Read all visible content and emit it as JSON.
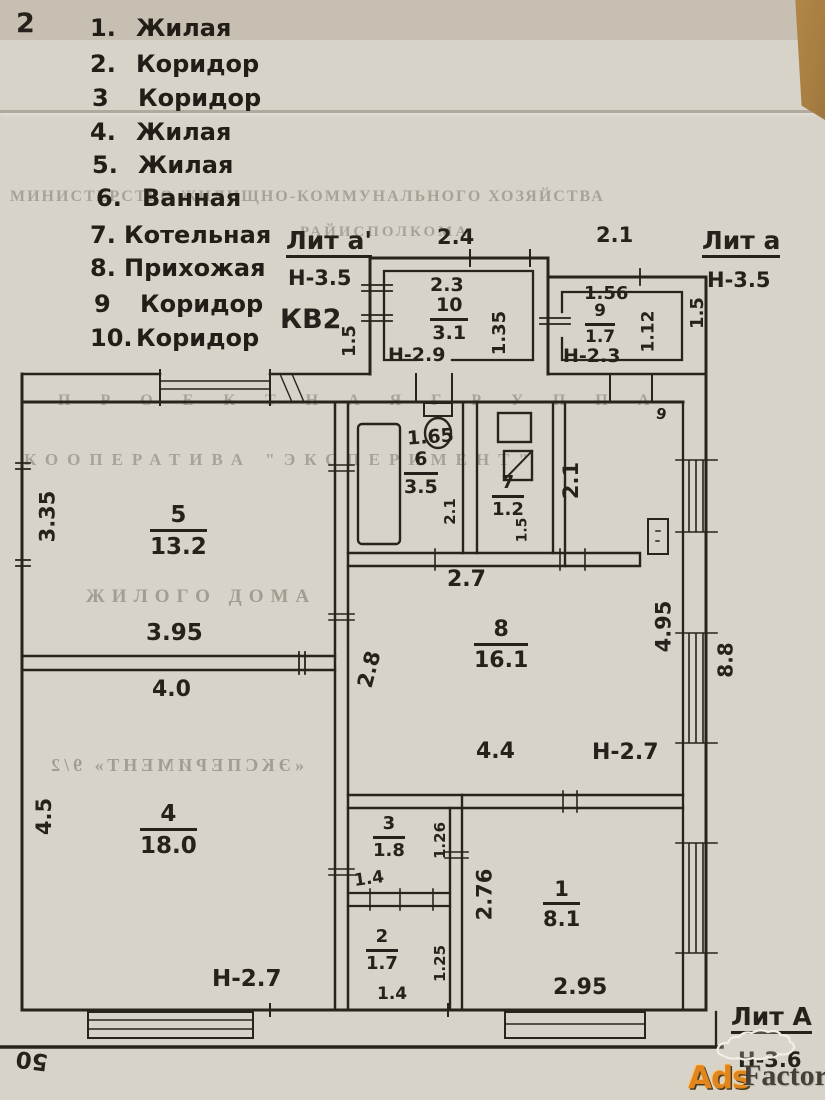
{
  "page": {
    "corner_mark": "2"
  },
  "legend": {
    "items": [
      {
        "num": "1.",
        "name": "Жилая"
      },
      {
        "num": "2.",
        "name": "Коридор"
      },
      {
        "num": "3",
        "name": "Коридор"
      },
      {
        "num": "4.",
        "name": "Жилая"
      },
      {
        "num": "5.",
        "name": "Жилая"
      },
      {
        "num": "6.",
        "name": "Ванная"
      },
      {
        "num": "7.",
        "name": "Котельная"
      },
      {
        "num": "8.",
        "name": "Прихожая"
      },
      {
        "num": "9",
        "name": "Коридор"
      },
      {
        "num": "10.",
        "name": "Коридор"
      }
    ]
  },
  "ghost": {
    "line1": "МИНИСТЕРСТВО ЖИЛИЩНО-КОММУНАЛЬНОГО ХОЗЯЙСТВА",
    "line2": "РАЙИСПОЛКОМА",
    "line3": "П Р О Е К Т Н А Я   Г Р У П П А",
    "line4": "КООПЕРАТИВА \"ЭКСПЕРИМЕНТ\"",
    "line5": "ЖИЛОГО ДОМА",
    "line6": "«ЭКСПЕРИМЕНТ» 9/2"
  },
  "plan": {
    "kv": "КВ2",
    "lit_a1": {
      "title": "Лит а'",
      "height": "Н-3.5"
    },
    "lit_a": {
      "title": "Лит а",
      "height": "Н-3.5"
    },
    "lit_A": {
      "title": "Лит А",
      "height": "Н-3.6"
    },
    "dims": {
      "kv_side": "1.5",
      "lit_a_side": "1.5",
      "top_left": "2.4",
      "top_right": "2.1",
      "mid_27": "2.7",
      "vert_21": "2.1",
      "right_88": "8.8",
      "bottom_50": "50",
      "door_mark": "9"
    },
    "rooms": {
      "r10": {
        "num": "10",
        "area": "3.1",
        "height": "Н-2.9",
        "d_top": "2.3",
        "d_side": "1.35"
      },
      "r9": {
        "num": "9",
        "area": "1.7",
        "height": "Н-2.3",
        "d_top": "1.56",
        "d_side": "1.12"
      },
      "r5": {
        "num": "5",
        "area": "13.2",
        "d_left": "3.35",
        "d_bottom": "3.95"
      },
      "r6": {
        "num": "6",
        "area": "3.5",
        "d_top": "1.65",
        "d_side": "2.1"
      },
      "r7": {
        "num": "7",
        "area": "1.2",
        "d_side": "1.5"
      },
      "r8": {
        "num": "8",
        "area": "16.1",
        "d_left": "2.8",
        "d_right": "4.95",
        "d_bottom": "4.4",
        "height": "Н-2.7"
      },
      "r4": {
        "num": "4",
        "area": "18.0",
        "d_top": "4.0",
        "d_left": "4.5",
        "height": "Н-2.7"
      },
      "r3": {
        "num": "3",
        "area": "1.8",
        "d_side": "1.26",
        "d_bottom": "1.4"
      },
      "r2": {
        "num": "2",
        "area": "1.7",
        "d_side": "1.25",
        "d_bottom": "1.4"
      },
      "r1": {
        "num": "1",
        "area": "8.1",
        "d_left": "2.76",
        "d_bottom": "2.95"
      }
    }
  },
  "watermark": {
    "ads": "Ads",
    "factory": "Factory"
  }
}
